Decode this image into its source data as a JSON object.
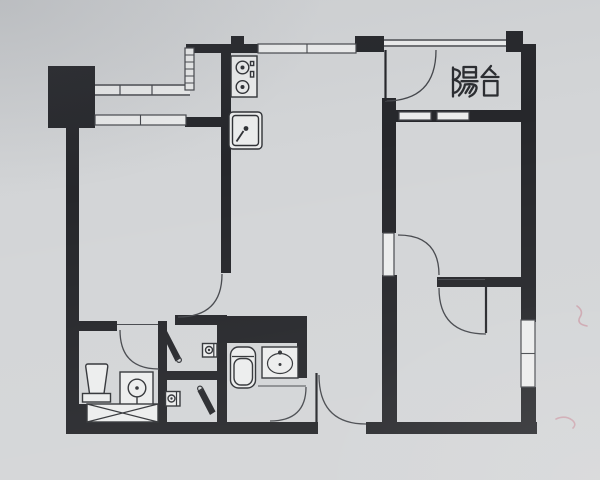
{
  "palette": {
    "paper": "#d3d5d7",
    "wall": "#26272b",
    "line": "#45474c",
    "window_fill": "#eceded",
    "fixture": "#303236",
    "label_ink": "#2b2d31",
    "mark": "#c98f9b"
  },
  "label": {
    "text": "陽台",
    "x": 448,
    "y": 64
  },
  "plan": {
    "walls": [
      {
        "name": "pillar-top-left",
        "r": [
          48,
          66,
          47,
          62
        ]
      },
      {
        "name": "left-exterior-wall",
        "r": [
          66,
          120,
          13,
          314
        ]
      },
      {
        "name": "bottom-wall-left",
        "r": [
          66,
          422,
          252,
          12
        ]
      },
      {
        "name": "bottom-wall-right",
        "r": [
          366,
          422,
          171,
          12
        ]
      },
      {
        "name": "right-exterior-wall-upper",
        "r": [
          521,
          44,
          15,
          278
        ]
      },
      {
        "name": "right-exterior-wall-lower",
        "r": [
          521,
          387,
          15,
          47
        ]
      },
      {
        "name": "top-wall-kitchen",
        "r": [
          186,
          44,
          74,
          9
        ]
      },
      {
        "name": "top-pillar-mid",
        "r": [
          355,
          36,
          29,
          16
        ]
      },
      {
        "name": "top-pillar-right",
        "r": [
          506,
          31,
          17,
          21
        ]
      },
      {
        "name": "kitchen-divider-wall",
        "r": [
          221,
          44,
          10,
          229
        ]
      },
      {
        "name": "kitchen-wall-bump",
        "r": [
          231,
          36,
          13,
          8
        ]
      },
      {
        "name": "wall-under-bay",
        "r": [
          185,
          117,
          46,
          10
        ]
      },
      {
        "name": "bedroom1-bottom-wall",
        "r": [
          175,
          315,
          52,
          10
        ]
      },
      {
        "name": "wc-right-wall",
        "r": [
          217,
          315,
          10,
          107
        ]
      },
      {
        "name": "bathroom1-top-wall",
        "r": [
          79,
          321,
          38,
          10
        ]
      },
      {
        "name": "bathroom1-right-wall",
        "r": [
          158,
          321,
          9,
          101
        ]
      },
      {
        "name": "wc-divider-wall",
        "r": [
          158,
          371,
          69,
          9
        ]
      },
      {
        "name": "bathroom2-top-slab",
        "r": [
          227,
          316,
          80,
          27
        ]
      },
      {
        "name": "bathroom2-right-wall",
        "r": [
          297,
          343,
          10,
          35
        ]
      },
      {
        "name": "living-divider-upper",
        "r": [
          382,
          98,
          14,
          135
        ]
      },
      {
        "name": "living-divider-lower",
        "r": [
          382,
          275,
          15,
          147
        ]
      },
      {
        "name": "bedroom2-bottom-wall",
        "r": [
          437,
          277,
          90,
          10
        ]
      },
      {
        "name": "laundry-corner-block",
        "r": [
          66,
          404,
          21,
          18
        ]
      },
      {
        "name": "balcony-bottom-wall",
        "r": [
          395,
          110,
          127,
          12
        ]
      }
    ],
    "windows": [
      {
        "name": "bay-upper-band",
        "style": "band",
        "x": 95,
        "y": 84,
        "w": 95,
        "h": 12,
        "ticks": [
          120,
          152
        ]
      },
      {
        "name": "bay-vertical-window",
        "style": "ladder",
        "x": 185,
        "y": 48,
        "w": 9,
        "h": 42,
        "rungs": 5
      },
      {
        "name": "kitchen-top-window",
        "style": "pane2",
        "x": 258,
        "y": 44,
        "w": 98,
        "h": 9
      },
      {
        "name": "bedroom1-window",
        "style": "pane2",
        "x": 95,
        "y": 115,
        "w": 91,
        "h": 10
      },
      {
        "name": "bedroom3-window",
        "style": "pane2v",
        "x": 521,
        "y": 320,
        "w": 14,
        "h": 67
      },
      {
        "name": "balcony-window-1",
        "style": "pane1",
        "x": 399,
        "y": 112,
        "w": 32,
        "h": 8
      },
      {
        "name": "balcony-window-2",
        "style": "pane1",
        "x": 437,
        "y": 112,
        "w": 32,
        "h": 8
      },
      {
        "name": "balcony-railing",
        "style": "band",
        "x": 384,
        "y": 39,
        "w": 122,
        "h": 8,
        "ticks": []
      },
      {
        "name": "bedroom2-door-leaf-panel",
        "style": "pane1",
        "x": 383,
        "y": 233,
        "w": 11,
        "h": 43
      }
    ],
    "door_arcs": [
      {
        "name": "balcony-door-arc",
        "d": "M385,101 Q436,101 436,50"
      },
      {
        "name": "bedroom2-door-arc",
        "d": "M398,235 Q439,235 439,275"
      },
      {
        "name": "bedroom3-door-arc",
        "d": "M439,288 Q439,334 486,334"
      },
      {
        "name": "entry-door-arc",
        "d": "M319,375 Q319,424 366,424"
      },
      {
        "name": "bathroom2-door-arc",
        "d": "M270,421 Q306,421 306,387"
      },
      {
        "name": "bathroom1-door-arc",
        "d": "M120,330 Q120,369 159,369"
      },
      {
        "name": "bedroom1-door-arc",
        "d": "M222,274 Q222,317 178,317"
      }
    ],
    "leaf_lines": [
      {
        "name": "balcony-door-leaf",
        "x1": 385.5,
        "y1": 50,
        "x2": 385.5,
        "y2": 101
      },
      {
        "name": "bedroom3-door-leaf",
        "x1": 486,
        "y1": 287,
        "x2": 486,
        "y2": 333
      },
      {
        "name": "entry-door-leaf",
        "x1": 316.5,
        "y1": 373,
        "x2": 316.5,
        "y2": 423
      }
    ],
    "thresholds": [
      {
        "name": "bathroom1-door-threshold",
        "x1": 117,
        "y1": 324.5,
        "x2": 158,
        "y2": 324.5
      },
      {
        "name": "bathroom2-door-threshold",
        "x1": 258,
        "y1": 386,
        "x2": 306,
        "y2": 386
      },
      {
        "name": "bedroom3-door-threshold",
        "x1": 438,
        "y1": 279.5,
        "x2": 485,
        "y2": 279.5
      }
    ],
    "door_wedges": [
      {
        "name": "wc-upper-door",
        "pts": "161,332 167,331 181,358 175.5,361.5",
        "dot": [
          179,
          360
        ]
      },
      {
        "name": "wc-lower-door",
        "pts": "210,415 215.5,411.5 203,387.5 197.5,391",
        "dot": [
          200,
          388.5
        ]
      }
    ],
    "fixtures": [
      {
        "name": "stove",
        "shapes": [
          {
            "t": "rect",
            "x": 231,
            "y": 56,
            "w": 26,
            "h": 41
          },
          {
            "t": "circle",
            "cx": 242.5,
            "cy": 67.5,
            "r": 6.3
          },
          {
            "t": "dot",
            "cx": 242.5,
            "cy": 67.5,
            "r": 2
          },
          {
            "t": "circle",
            "cx": 242.5,
            "cy": 87,
            "r": 6.3
          },
          {
            "t": "dot",
            "cx": 242.5,
            "cy": 87,
            "r": 2
          },
          {
            "t": "rect",
            "x": 250.5,
            "y": 61.5,
            "w": 3.2,
            "h": 4
          },
          {
            "t": "rect",
            "x": 250.5,
            "y": 71.5,
            "w": 3.2,
            "h": 5.5
          }
        ]
      },
      {
        "name": "kitchen-sink",
        "shapes": [
          {
            "t": "rect",
            "x": 229,
            "y": 112,
            "w": 33,
            "h": 37,
            "rx": 4
          },
          {
            "t": "rect",
            "x": 232.5,
            "y": 115.5,
            "w": 26,
            "h": 30,
            "rx": 3
          },
          {
            "t": "dot",
            "cx": 246,
            "cy": 128.5,
            "r": 2.4
          },
          {
            "t": "line",
            "x1": 243.5,
            "y1": 131,
            "x2": 236.5,
            "y2": 141.5,
            "sw": 1.8
          }
        ]
      },
      {
        "name": "toilet-1",
        "shapes": [
          {
            "t": "path",
            "d": "M88,364 L105.5,364 Q108,364 107.7,367 L104,393.5 L89.5,393.5 L85.8,367 Q85.5,364 88,364 Z"
          },
          {
            "t": "rect",
            "x": 82.5,
            "y": 393.5,
            "w": 28,
            "h": 8.5
          }
        ]
      },
      {
        "name": "shower-drain",
        "shapes": [
          {
            "t": "rect",
            "x": 120,
            "y": 372,
            "w": 33,
            "h": 34
          },
          {
            "t": "circle",
            "cx": 137,
            "cy": 388,
            "r": 8.8
          },
          {
            "t": "dot",
            "cx": 137,
            "cy": 388,
            "r": 1.8
          },
          {
            "t": "line",
            "x1": 137,
            "y1": 396.8,
            "x2": 137,
            "y2": 403.5,
            "sw": 1.4
          }
        ]
      },
      {
        "name": "washer-area",
        "shapes": [
          {
            "t": "rect",
            "x": 87,
            "y": 404,
            "w": 71,
            "h": 18
          },
          {
            "t": "line",
            "x1": 87,
            "y1": 404,
            "x2": 158,
            "y2": 422,
            "sw": 1.2
          },
          {
            "t": "line",
            "x1": 87,
            "y1": 422,
            "x2": 158,
            "y2": 404,
            "sw": 1.2
          }
        ]
      },
      {
        "name": "toilet-2",
        "shapes": [
          {
            "t": "rect",
            "x": 230.5,
            "y": 347,
            "w": 25,
            "h": 41,
            "rx": 8
          },
          {
            "t": "rect",
            "x": 234,
            "y": 358.5,
            "w": 18.5,
            "h": 26.5,
            "rx": 7
          },
          {
            "t": "line",
            "x1": 232,
            "y1": 356.5,
            "x2": 254,
            "y2": 356.5,
            "sw": 1.2
          }
        ]
      },
      {
        "name": "bathroom2-sink",
        "shapes": [
          {
            "t": "rect",
            "x": 262,
            "y": 347,
            "w": 36,
            "h": 31
          },
          {
            "t": "ellipse",
            "cx": 280,
            "cy": 363.5,
            "rx": 12.5,
            "ry": 10
          },
          {
            "t": "dot",
            "cx": 280,
            "cy": 352.5,
            "r": 2.1
          },
          {
            "t": "dot",
            "cx": 280,
            "cy": 364.5,
            "r": 1.5
          }
        ]
      },
      {
        "name": "wc-upper-sink",
        "shapes": [
          {
            "t": "rect",
            "x": 202.5,
            "y": 343.5,
            "w": 14.5,
            "h": 13.5
          },
          {
            "t": "circle",
            "cx": 209,
            "cy": 350,
            "r": 3.5
          },
          {
            "t": "dot",
            "cx": 209,
            "cy": 350,
            "r": 1.2
          },
          {
            "t": "line",
            "x1": 213.8,
            "y1": 343.5,
            "x2": 213.8,
            "y2": 357,
            "sw": 1.2
          }
        ]
      },
      {
        "name": "wc-lower-sink",
        "shapes": [
          {
            "t": "rect",
            "x": 165.5,
            "y": 391.5,
            "w": 14.5,
            "h": 14.5
          },
          {
            "t": "circle",
            "cx": 171.5,
            "cy": 398.5,
            "r": 3.5
          },
          {
            "t": "dot",
            "cx": 171.5,
            "cy": 398.5,
            "r": 1.2
          },
          {
            "t": "line",
            "x1": 176.5,
            "y1": 391.5,
            "x2": 176.5,
            "y2": 406,
            "sw": 1.2
          }
        ]
      }
    ],
    "label_glyphs": [
      "M453,67.5 V96.5",
      "M453,69 Q462.5,70.5 459,76 Q456.5,80 453,79.5",
      "M453,79.5 Q463.5,82 459.5,88.5 Q456.5,93.5 453,92.5",
      "M463.5,67 H476 V77.5 H463.5 Z",
      "M463.5,72.3 H476",
      "M461.5,81.2 H477.5",
      "M465,84.5 Q464,90.5 459,95.5",
      "M465,84.5 Q477.5,83 476.5,88.5 Q475.5,94 469.5,96.5",
      "M469.5,86.5 L465.5,93",
      "M473.5,86.5 L469.5,93",
      "M491,66 L482,76.5",
      "M489.5,69 L495.5,74.5",
      "M481.5,77 H498.5",
      "M484,81 H497.5 V95.5 H484 Z"
    ],
    "pen_marks": [
      {
        "name": "pen-mark-1",
        "d": "M577,306 q7,5 3,11 q-4,7 7,9"
      },
      {
        "name": "pen-mark-2",
        "d": "M556,419 q9,-4 16,1 q5,4 1,8"
      }
    ]
  }
}
